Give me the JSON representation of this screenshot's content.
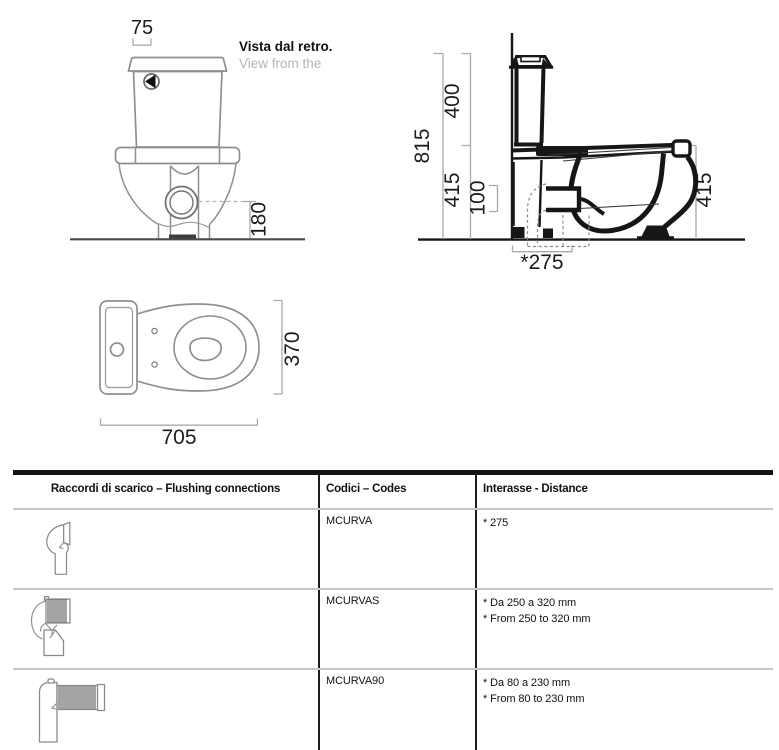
{
  "drawing": {
    "rear_view": {
      "caption_line1": "Vista dal retro.",
      "caption_line2": "View from the",
      "dim_top": "75",
      "dim_drain_height": "180"
    },
    "side_view": {
      "dim_total_height": "815",
      "dim_tank_section": "400",
      "dim_bowl_height_left": "415",
      "dim_drain_offset": "100",
      "dim_drain_distance": "*275",
      "dim_bowl_height_right": "415"
    },
    "top_view": {
      "dim_width": "370",
      "dim_length": "705"
    }
  },
  "table": {
    "headers": [
      "Raccordi di scarico – Flushing connections",
      "Codici – Codes",
      "Interasse - Distance"
    ],
    "rows": [
      {
        "icon": "elbow-connector-icon",
        "code": "MCURVA",
        "distance": [
          "* 275"
        ]
      },
      {
        "icon": "flexible-elbow-connector-icon",
        "code": "MCURVAS",
        "distance": [
          "* Da 250 a 320 mm",
          "* From 250 to 320 mm"
        ]
      },
      {
        "icon": "flexible-90-connector-icon",
        "code": "MCURVA90",
        "distance": [
          "* Da 80 a 230 mm",
          "* From 80 to 230 mm"
        ]
      }
    ]
  },
  "colors": {
    "drawing_outline_gray": "#8f8f8f",
    "drawing_outline_black": "#161616",
    "dimension_line": "#a9a9a9",
    "dimension_text": "#1c1c1c",
    "caption_muted": "#b5b5b5",
    "table_border_dark": "#1c1c1c",
    "row_separator": "#c9c9c9"
  }
}
